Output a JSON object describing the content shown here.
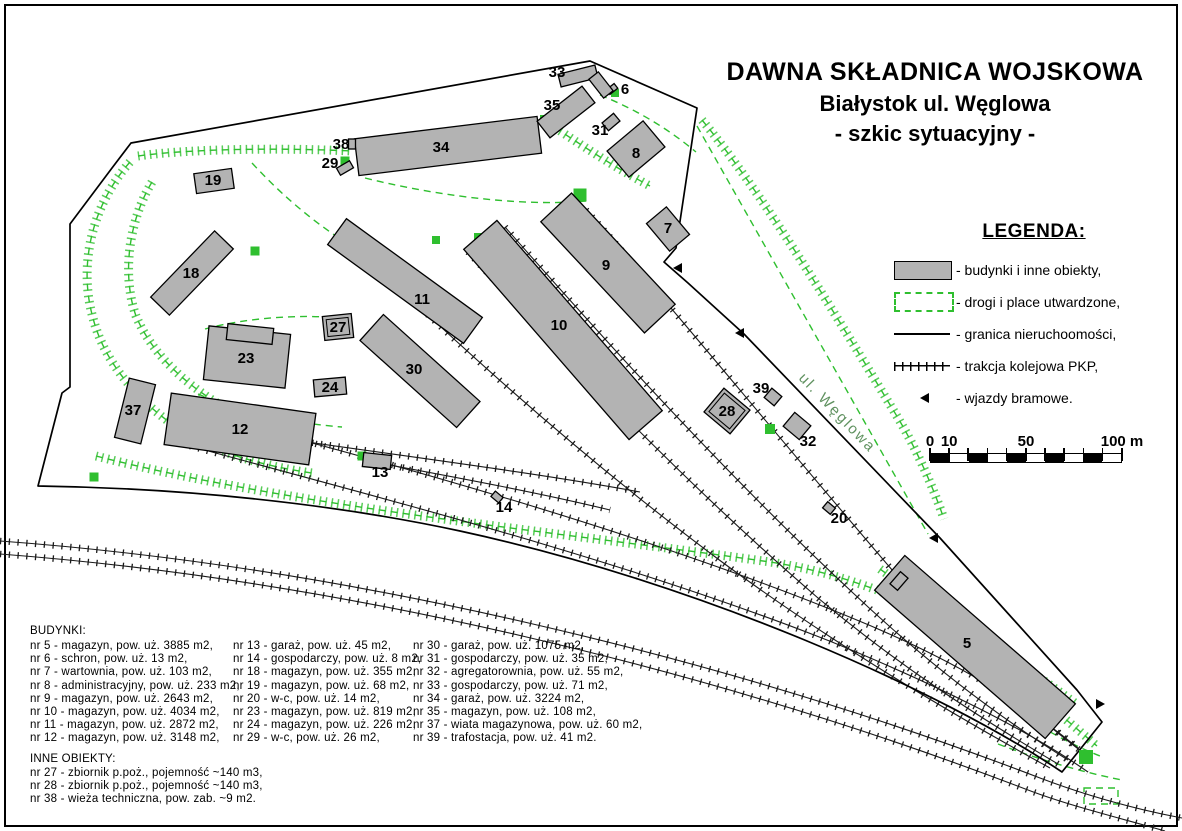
{
  "title": {
    "line1": "DAWNA SKŁADNICA WOJSKOWA",
    "line2": "Białystok ul. Węglowa",
    "line3": "- szkic sytuacyjny -"
  },
  "legend": {
    "heading": "LEGENDA:",
    "items": [
      {
        "symbol": "building",
        "label": "- budynki i inne obiekty,"
      },
      {
        "symbol": "road",
        "label": "- drogi i place utwardzone,"
      },
      {
        "symbol": "boundary",
        "label": "- granica nieruchoomości,"
      },
      {
        "symbol": "rail",
        "label": "- trakcja kolejowa PKP,"
      },
      {
        "symbol": "gate",
        "label": "- wjazdy bramowe."
      }
    ]
  },
  "scale_bar": {
    "total_m": 100,
    "segment_m": 10,
    "labels": [
      {
        "text": "0",
        "m": 0
      },
      {
        "text": "10",
        "m": 10
      },
      {
        "text": "50",
        "m": 50
      },
      {
        "text": "100 m",
        "m": 100
      }
    ]
  },
  "buildings_list": {
    "heading": "BUDYNKI:",
    "columns": [
      [
        "nr 5 - magazyn, pow. uż. 3885 m2,",
        "nr 6 - schron, pow. uż. 13 m2,",
        "nr 7 - wartownia, pow. uż. 103 m2,",
        "nr 8 - administracyjny, pow. uż. 233 m2,",
        "nr 9 - magazyn, pow. uż. 2643 m2,",
        "nr 10 - magazyn, pow. uż. 4034 m2,",
        "nr 11 - magazyn, pow. uż. 2872 m2,",
        "nr 12 - magazyn, pow. uż. 3148 m2,"
      ],
      [
        "nr 13 - garaż, pow. uż. 45 m2,",
        "nr 14 - gospodarczy, pow. uż. 8 m2,",
        "nr 18 - magazyn, pow. uż. 355 m2,",
        "nr 19 - magazyn, pow. uż. 68 m2,",
        "nr 20 - w-c, pow. uż. 14 m2,",
        "nr 23 - magazyn, pow. uż. 819 m2,",
        "nr 24 - magazyn, pow. uż. 226 m2,",
        "nr 29 - w-c, pow. uż. 26 m2,"
      ],
      [
        "nr 30 - garaż, pow. uż. 1075 m2,",
        "nr 31 - gospodarczy, pow. uż. 35 m2,",
        "nr 32 - agregatorownia, pow. uż. 55 m2,",
        "nr 33 - gospodarczy, pow. uż. 71 m2,",
        "nr 34 - garaż, pow. uż. 3224 m2,",
        "nr 35 - magazyn, pow. uż. 108 m2,",
        "nr 37 - wiata magazynowa, pow. uż. 60 m2,",
        "nr 39 - trafostacja, pow. uż. 41 m2."
      ]
    ]
  },
  "other_objects": {
    "heading": "INNE OBIEKTY:",
    "items": [
      "nr 27 - zbiornik p.poż., pojemność ~140 m3,",
      "nr 28 - zbiornik p.poż., pojemność ~140 m3,",
      "nr 38 - wieża techniczna, pow. zab. ~9 m2."
    ]
  },
  "colors": {
    "building_fill": "#b3b3b3",
    "road_green": "#2fbf2f",
    "boundary_black": "#000000",
    "street_label_green": "#5f915f"
  },
  "map": {
    "street_label": {
      "text": "ul. Węglowa",
      "x": 834,
      "y": 416,
      "rot": 46
    },
    "boundary_path": "M590,61 L697,108 L676,248 L664,262 L688,283 L744,334 L940,538 L1077,690 L1102,722 L1062,772 C940,690 700,583 460,531 C330,503 180,488 38,486 L62,393 L70,387 L70,224 L112,168 L131,143 Z",
    "railways": [
      "M0,541 C340,566 720,655 1040,778 C1090,797 1140,810 1182,818",
      "M0,554 C340,580 710,668 1028,790 C1070,806 1120,818 1165,831",
      "M586,210 C650,280 780,440 905,585 C965,655 1025,708 1082,752",
      "M505,227 C565,295 705,455 852,592 C928,664 1000,718 1068,760",
      "M468,252 C540,330 675,475 818,598 C898,665 975,715 1058,764",
      "M352,241 C425,315 565,445 722,562 C832,643 948,712 1050,768",
      "M222,419 C410,468 655,537 852,618 C950,658 1020,700 1078,748",
      "M190,446 C380,498 625,560 832,642 C935,684 1028,730 1088,772",
      "M368,461 C460,478 545,494 610,510",
      "M225,430 C370,452 520,470 640,492"
    ],
    "roads_hatched": [
      "M138,156 C180,150 265,147 352,151",
      "M130,162 C92,205 78,265 93,318 C104,362 138,402 182,431 C212,451 262,466 312,473",
      "M96,456 C300,508 560,532 770,562 C890,580 990,640 1075,703",
      "M702,120 C760,190 830,305 898,418 C917,450 933,487 944,519",
      "M880,569 C950,620 1022,682 1097,746",
      "M545,121 C577,142 612,166 650,186",
      "M152,182 C128,222 122,276 136,316 C151,352 182,382 222,406"
    ],
    "roads_dashed": [
      "M252,163 C300,215 352,252 412,277",
      "M365,178 C450,199 532,206 586,201",
      "M600,95 C642,112 672,132 696,152",
      "M697,126 L928,534",
      "M205,329 C245,318 300,314 338,318",
      "M198,394 C240,412 292,423 342,427",
      "M998,744 C1040,760 1082,772 1122,780",
      "M1040,726 C1060,738 1080,748 1100,756"
    ],
    "roads_dashed_rects": [
      {
        "cx": 1101,
        "cy": 796,
        "w": 34,
        "h": 16,
        "rot": 0
      }
    ],
    "green_patches": [
      {
        "x": 580,
        "y": 195,
        "s": 13
      },
      {
        "x": 545,
        "y": 120,
        "s": 10
      },
      {
        "x": 345,
        "y": 161,
        "s": 9
      },
      {
        "x": 207,
        "y": 183,
        "s": 10
      },
      {
        "x": 255,
        "y": 251,
        "s": 9
      },
      {
        "x": 197,
        "y": 431,
        "s": 10
      },
      {
        "x": 362,
        "y": 456,
        "s": 9
      },
      {
        "x": 770,
        "y": 429,
        "s": 10
      },
      {
        "x": 1086,
        "y": 757,
        "s": 14
      },
      {
        "x": 905,
        "y": 583,
        "s": 9
      },
      {
        "x": 94,
        "y": 477,
        "s": 9
      },
      {
        "x": 615,
        "y": 93,
        "s": 8
      },
      {
        "x": 436,
        "y": 240,
        "s": 8
      },
      {
        "x": 478,
        "y": 237,
        "s": 8
      }
    ],
    "gates": [
      {
        "x": 682,
        "y": 268,
        "rot": 0
      },
      {
        "x": 744,
        "y": 333,
        "rot": 0
      },
      {
        "x": 938,
        "y": 538,
        "rot": 0
      },
      {
        "x": 1096,
        "y": 704,
        "rot": 180
      }
    ],
    "buildings": [
      {
        "id": "5",
        "label": "5",
        "cx": 975,
        "cy": 647,
        "w": 226,
        "h": 46,
        "rot": 41,
        "lx": 967,
        "ly": 648
      },
      {
        "id": "5-wing",
        "label": "",
        "cx": 899,
        "cy": 581,
        "w": 10,
        "h": 16,
        "rot": 41
      },
      {
        "id": "6",
        "label": "6",
        "cx": 612,
        "cy": 89,
        "w": 10,
        "h": 6,
        "rot": -38,
        "lx": 625,
        "ly": 94
      },
      {
        "id": "7",
        "label": "7",
        "cx": 668,
        "cy": 229,
        "w": 26,
        "h": 36,
        "rot": -40,
        "lx": 668,
        "ly": 233
      },
      {
        "id": "8",
        "label": "8",
        "cx": 636,
        "cy": 149,
        "w": 47,
        "h": 34,
        "rot": -40,
        "lx": 636,
        "ly": 158
      },
      {
        "id": "9",
        "label": "9",
        "cx": 608,
        "cy": 263,
        "w": 152,
        "h": 42,
        "rot": 47,
        "lx": 606,
        "ly": 270
      },
      {
        "id": "10",
        "label": "10",
        "cx": 563,
        "cy": 330,
        "w": 252,
        "h": 44,
        "rot": 49,
        "lx": 559,
        "ly": 330
      },
      {
        "id": "11",
        "label": "11",
        "cx": 405,
        "cy": 281,
        "w": 168,
        "h": 32,
        "rot": 36,
        "lx": 422,
        "ly": 304
      },
      {
        "id": "12",
        "label": "12",
        "cx": 240,
        "cy": 429,
        "w": 146,
        "h": 52,
        "rot": 8,
        "lx": 240,
        "ly": 434
      },
      {
        "id": "13",
        "label": "13",
        "cx": 377,
        "cy": 461,
        "w": 28,
        "h": 14,
        "rot": 6,
        "lx": 380,
        "ly": 477
      },
      {
        "id": "14",
        "label": "14",
        "cx": 497,
        "cy": 497,
        "w": 10,
        "h": 7,
        "rot": 40,
        "lx": 504,
        "ly": 512
      },
      {
        "id": "18",
        "label": "18",
        "cx": 192,
        "cy": 273,
        "w": 92,
        "h": 26,
        "rot": -46,
        "lx": 191,
        "ly": 278
      },
      {
        "id": "19",
        "label": "19",
        "cx": 214,
        "cy": 181,
        "w": 38,
        "h": 20,
        "rot": -8,
        "lx": 213,
        "ly": 185
      },
      {
        "id": "20",
        "label": "20",
        "cx": 829,
        "cy": 508,
        "w": 10,
        "h": 8,
        "rot": 40,
        "lx": 839,
        "ly": 523
      },
      {
        "id": "23",
        "label": "23",
        "cx": 247,
        "cy": 357,
        "w": 82,
        "h": 54,
        "rot": 6,
        "lx": 246,
        "ly": 363
      },
      {
        "id": "23-wing",
        "label": "",
        "cx": 250,
        "cy": 334,
        "w": 46,
        "h": 16,
        "rot": 6
      },
      {
        "id": "24",
        "label": "24",
        "cx": 330,
        "cy": 387,
        "w": 32,
        "h": 17,
        "rot": -5,
        "lx": 330,
        "ly": 392
      },
      {
        "id": "27",
        "label": "27",
        "cx": 338,
        "cy": 327,
        "w": 29,
        "h": 24,
        "rot": -6,
        "double": true,
        "lx": 338,
        "ly": 332
      },
      {
        "id": "28",
        "label": "28",
        "cx": 727,
        "cy": 411,
        "w": 34,
        "h": 31,
        "rot": 40,
        "double": true,
        "lx": 727,
        "ly": 416
      },
      {
        "id": "29",
        "label": "29",
        "cx": 345,
        "cy": 168,
        "w": 15,
        "h": 8,
        "rot": -30,
        "lx": 330,
        "ly": 168
      },
      {
        "id": "30",
        "label": "30",
        "cx": 420,
        "cy": 371,
        "w": 130,
        "h": 35,
        "rot": 42,
        "lx": 414,
        "ly": 374
      },
      {
        "id": "31",
        "label": "31",
        "cx": 611,
        "cy": 122,
        "w": 15,
        "h": 10,
        "rot": -40,
        "lx": 600,
        "ly": 135
      },
      {
        "id": "32",
        "label": "32",
        "cx": 797,
        "cy": 426,
        "w": 21,
        "h": 18,
        "rot": 40,
        "lx": 808,
        "ly": 446
      },
      {
        "id": "33",
        "label": "33",
        "cx": 578,
        "cy": 76,
        "w": 38,
        "h": 13,
        "rot": -14,
        "lx": 557,
        "ly": 77
      },
      {
        "id": "33-wing",
        "label": "",
        "cx": 601,
        "cy": 85,
        "w": 24,
        "h": 12,
        "rot": 52
      },
      {
        "id": "34",
        "label": "34",
        "cx": 448,
        "cy": 146,
        "w": 184,
        "h": 37,
        "rot": -7,
        "lx": 441,
        "ly": 152
      },
      {
        "id": "35",
        "label": "35",
        "cx": 566,
        "cy": 112,
        "w": 57,
        "h": 21,
        "rot": -38,
        "lx": 552,
        "ly": 110
      },
      {
        "id": "37",
        "label": "37",
        "cx": 135,
        "cy": 411,
        "w": 27,
        "h": 61,
        "rot": 14,
        "lx": 133,
        "ly": 415
      },
      {
        "id": "38",
        "label": "38",
        "cx": 352,
        "cy": 144,
        "w": 7,
        "h": 10,
        "rot": 0,
        "lx": 341,
        "ly": 149
      },
      {
        "id": "39",
        "label": "39",
        "cx": 773,
        "cy": 397,
        "w": 13,
        "h": 12,
        "rot": 40,
        "lx": 761,
        "ly": 393
      }
    ]
  }
}
